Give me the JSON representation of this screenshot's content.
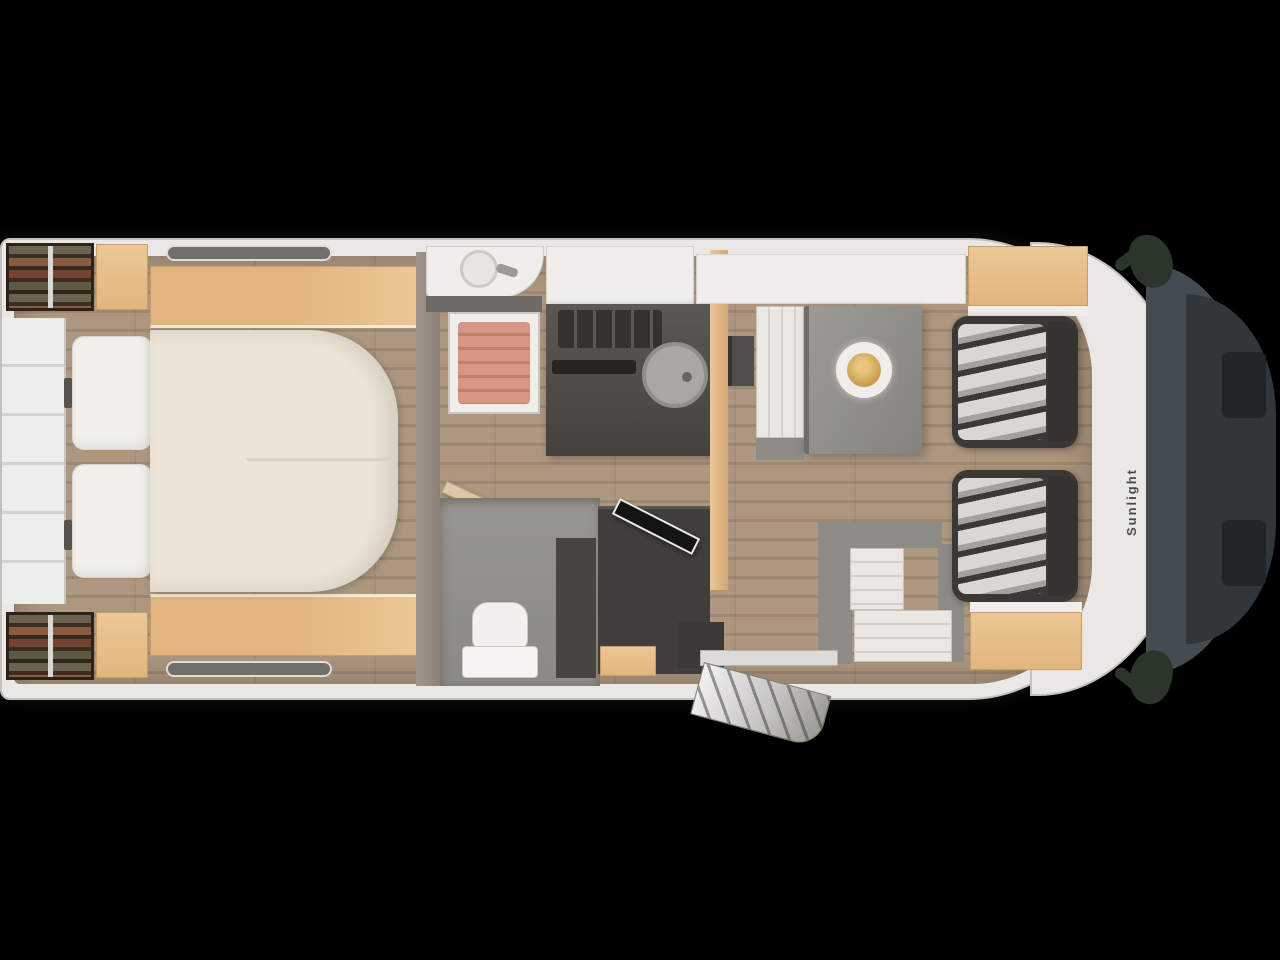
{
  "scene": {
    "brand_text": "Sunlight",
    "description": "motorhome-top-view-floorplan"
  },
  "zones": [
    "rear-wardrobe-shelves",
    "rear-island-bed",
    "bedside-shelves",
    "washroom-basin",
    "shower-cubicle",
    "toilet-room",
    "kitchen-block",
    "round-kitchen-sink",
    "gas-hob",
    "tall-fridge-cabinet",
    "tv-unit",
    "dinette-table",
    "front-bench",
    "l-shaped-side-bench",
    "entry-door-with-step",
    "driver-swivel-seat",
    "passenger-swivel-seat",
    "cab-front",
    "side-mirrors"
  ],
  "colors": {
    "bg": "#000000",
    "shell": "#e9e8e4",
    "shell_edge": "#c2c1bd",
    "floor": "#ad977f",
    "floor_dark": "#9c8771",
    "tan": "#e2b57e",
    "tan_light": "#ecc795",
    "mattress": "#eae4d5",
    "pillow": "#f1f0ea",
    "hob": "#33322d",
    "metal": "#a8a7a1",
    "shower": "#d69885",
    "shower_stripe": "#c47e6b",
    "table": "#8f8e88",
    "frame": "#8c8b85",
    "cushion": "#e9e8e3",
    "cushion_stripe": "#d2d1cc",
    "seat": "#3a3936",
    "seat_light": "#d8d7d2",
    "windshield": "#454c51",
    "front": "#30363a",
    "mirror": "#2b3529",
    "gold": "#c89b4e",
    "white_trim": "#efeeea"
  }
}
